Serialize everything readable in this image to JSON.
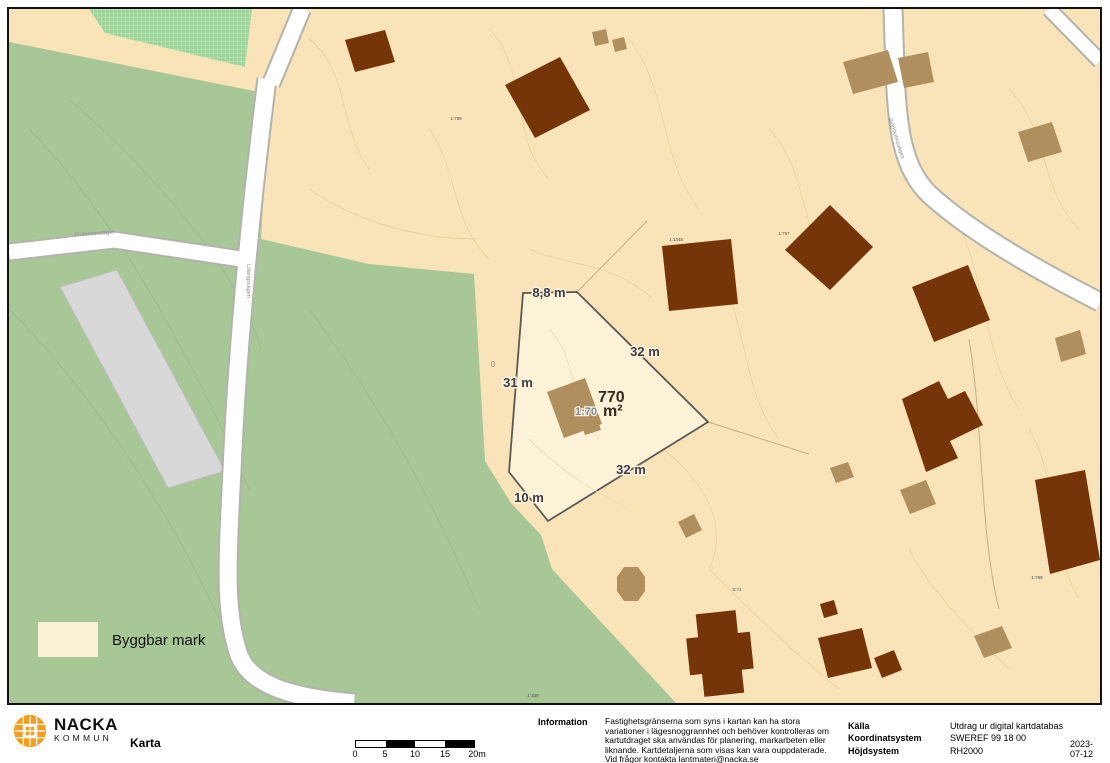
{
  "map": {
    "legend_label": "Byggbar mark",
    "parcel": {
      "area": "770",
      "unit": "m²",
      "designation": "1:70",
      "m_top": "8,8 m",
      "m_right": "32 m",
      "m_left": "31 m",
      "m_bottom": "32 m",
      "m_bottom_left": "10 m",
      "contour_label": "0"
    },
    "cadastral_labels": {
      "c1": "1:798",
      "c2": "1:1348",
      "c3": "1:767",
      "c4": "S:71",
      "c5": "1:769",
      "c6": "1:338"
    },
    "street_names": {
      "left": "Professorsstigen",
      "vertical": "Lillängsvägen",
      "right": "Björkholmsvägen"
    }
  },
  "footer": {
    "logo": {
      "line1": "NACKA",
      "line2": "KOMMUN"
    },
    "title": "Karta",
    "scale": {
      "ticks": [
        "0",
        "5",
        "10",
        "15",
        "20m"
      ]
    },
    "info_label": "Information",
    "info_lines": [
      "Fastighetsgränserna som syns i kartan kan ha stora",
      "variationer i lägesnoggrannhet och behöver kontrolleras om",
      "kartutdraget ska användas för planering, markarbeten eller",
      "liknande. Kartdetaljerna som visas kan vara ouppdaterade.",
      "Vid frågor kontakta lantmateri@nacka.se"
    ],
    "meta": {
      "source_label": "Källa",
      "source_value": "Utdrag ur digital kartdatabas",
      "coord_label": "Koordinatsystem",
      "coord_value": "SWEREF 99 18 00",
      "height_label": "Höjdsystem",
      "height_value": "RH2000",
      "date_line1": "2023-",
      "date_line2": "07-12"
    }
  },
  "colors": {
    "map_green": "#a7c797",
    "map_tan": "#f9e4b9",
    "parcel_fill": "#fbf2d8",
    "building_dark": "#753508",
    "building_light": "#b08f5e",
    "building_gray": "#d8d8d8",
    "road": "#ffffff",
    "legend_swatch": "#faf0d6",
    "logo_orange": "#f89c1c",
    "measurement_text": "#3c3d49",
    "designation_text": "#8285a3"
  }
}
